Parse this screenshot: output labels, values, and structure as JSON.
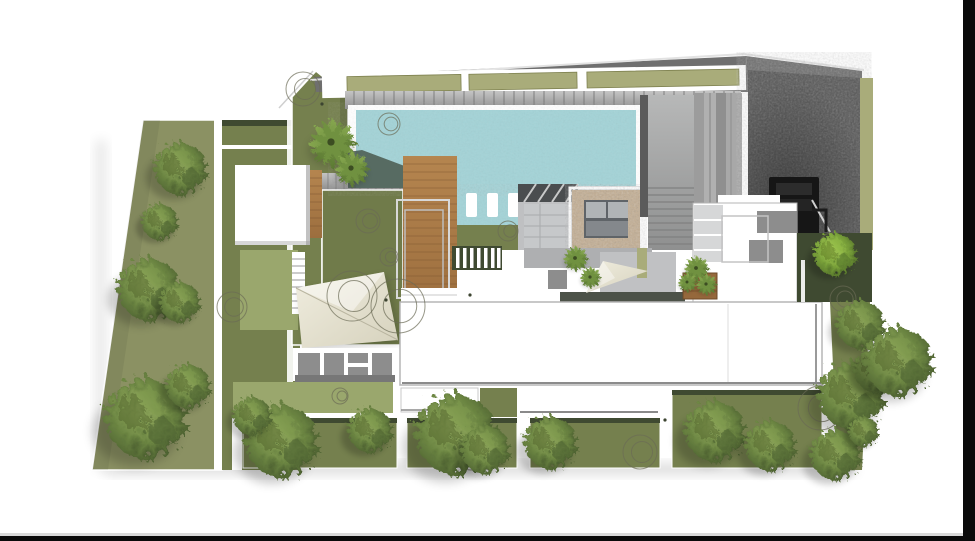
{
  "scene": {
    "kind": "architectural-site-plan-rendering",
    "text_content": "none"
  },
  "palette": {
    "bg": "#ffffff",
    "edge_bar": "#0a0a0a",
    "edge_hairline": "#d9d9d9",
    "lawn": "#8b9163",
    "lawn_light": "#9aa76d",
    "garden": "#75804e",
    "garden2": "#707b4a",
    "garden_dark": "#3f4a31",
    "water": "#a3d3d7",
    "pool_shadow": "#4f5f55",
    "wood": "#b0804d",
    "wood_line": "#7c5530",
    "planter": "#95683c",
    "roof_dark": "#6f6f6f",
    "olive_roof": "#a9ac7a",
    "louver_line": "#6e6e6e",
    "wall_dark": "#5b5b5b",
    "pavers": "#565656",
    "roof_edge": "#9a9a9a",
    "gray_accent": "#8d8d8d",
    "panel_gray": "#d6d7d8",
    "stone": "#bfc0c2",
    "stone_mid": "#aeafb1",
    "deck_dark": "#4c5248",
    "cushion": "#c3ae93",
    "spa_inner": "#5f6468",
    "spa_pad": "#b0b4b6",
    "canopy_dark": "#4a4d4f",
    "sail": "#eae7d9",
    "sail_shade": "#d9d5c2",
    "annot": "#6b6b55",
    "dot": "#3c4430",
    "black_object": "#161616"
  },
  "foliage": {
    "trees": [
      {
        "x": 178,
        "y": 166,
        "r": 26
      },
      {
        "x": 158,
        "y": 220,
        "r": 18
      },
      {
        "x": 146,
        "y": 286,
        "r": 31
      },
      {
        "x": 178,
        "y": 300,
        "r": 20
      },
      {
        "x": 142,
        "y": 414,
        "r": 40
      },
      {
        "x": 186,
        "y": 384,
        "r": 22
      },
      {
        "x": 278,
        "y": 437,
        "r": 36
      },
      {
        "x": 250,
        "y": 414,
        "r": 19
      },
      {
        "x": 368,
        "y": 428,
        "r": 22
      },
      {
        "x": 452,
        "y": 430,
        "r": 40
      },
      {
        "x": 483,
        "y": 447,
        "r": 24
      },
      {
        "x": 548,
        "y": 440,
        "r": 26
      },
      {
        "x": 712,
        "y": 428,
        "r": 30
      },
      {
        "x": 768,
        "y": 443,
        "r": 25
      },
      {
        "x": 833,
        "y": 252,
        "r": 21,
        "v": "bright"
      },
      {
        "x": 858,
        "y": 322,
        "r": 24
      },
      {
        "x": 848,
        "y": 392,
        "r": 33
      },
      {
        "x": 874,
        "y": 368,
        "r": 22
      },
      {
        "x": 895,
        "y": 358,
        "r": 34
      },
      {
        "x": 833,
        "y": 452,
        "r": 25
      },
      {
        "x": 862,
        "y": 430,
        "r": 15
      }
    ],
    "palms": [
      {
        "x": 331,
        "y": 142,
        "r": 25
      },
      {
        "x": 351,
        "y": 168,
        "r": 18
      },
      {
        "x": 575,
        "y": 258,
        "r": 13
      },
      {
        "x": 590,
        "y": 277,
        "r": 11
      },
      {
        "x": 696,
        "y": 268,
        "r": 13
      },
      {
        "x": 706,
        "y": 284,
        "r": 11
      },
      {
        "x": 687,
        "y": 282,
        "r": 10
      }
    ],
    "annotation_circles": [
      {
        "x": 303,
        "y": 89,
        "r": 17
      },
      {
        "x": 389,
        "y": 124,
        "r": 11
      },
      {
        "x": 368,
        "y": 221,
        "r": 12
      },
      {
        "x": 389,
        "y": 257,
        "r": 9
      },
      {
        "x": 352,
        "y": 296,
        "r": 25
      },
      {
        "x": 398,
        "y": 306,
        "r": 27
      },
      {
        "x": 232,
        "y": 307,
        "r": 15
      },
      {
        "x": 640,
        "y": 452,
        "r": 17
      },
      {
        "x": 820,
        "y": 408,
        "r": 22
      },
      {
        "x": 843,
        "y": 299,
        "r": 13
      },
      {
        "x": 832,
        "y": 246,
        "r": 13
      },
      {
        "x": 471,
        "y": 455,
        "r": 15
      },
      {
        "x": 508,
        "y": 231,
        "r": 10
      },
      {
        "x": 340,
        "y": 396,
        "r": 8
      }
    ],
    "dots": [
      {
        "x": 322,
        "y": 104
      },
      {
        "x": 360,
        "y": 438
      },
      {
        "x": 470,
        "y": 295
      },
      {
        "x": 386,
        "y": 300
      },
      {
        "x": 665,
        "y": 420
      }
    ]
  }
}
